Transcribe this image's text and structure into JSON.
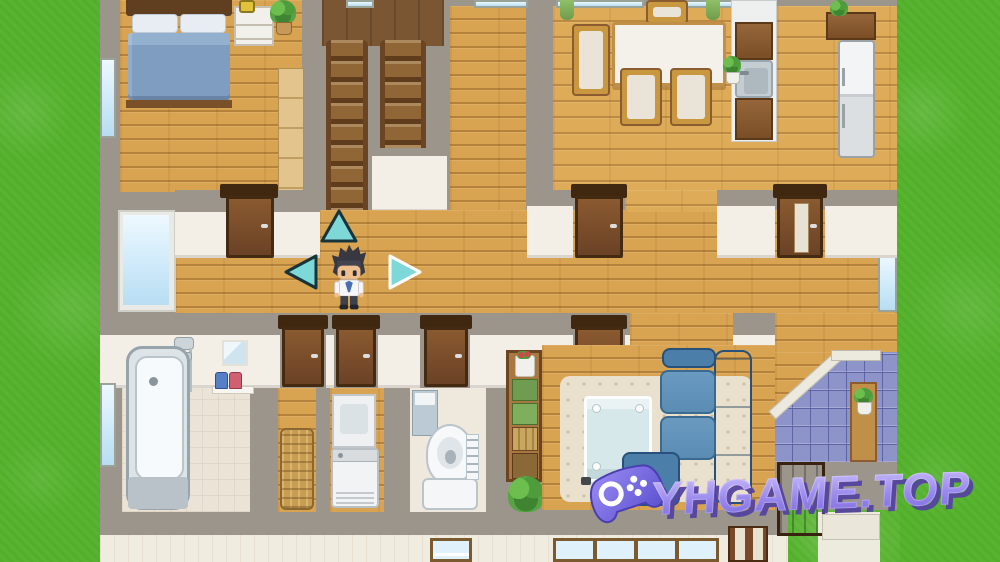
{
  "scene": {
    "description": "Top-down RPG-style house interior map with player character standing in a hallway",
    "rooms": [
      "bedroom",
      "staircase",
      "corridor",
      "dining-room",
      "kitchen",
      "hallway",
      "bathroom",
      "laundry-room",
      "toilet-room",
      "living-room",
      "entryway",
      "yard"
    ],
    "objects": [
      "double-bed",
      "nightstand",
      "alarm-clock",
      "potted-plant",
      "closet",
      "stairs-up",
      "dining-table",
      "chairs",
      "kitchen-sink",
      "refrigerator",
      "bathtub",
      "shower",
      "mirror",
      "shampoo-bottles",
      "laundry-basket",
      "washing-machine",
      "toilet",
      "bookshelf",
      "glass-table",
      "blue-sofa",
      "rug",
      "entry-tiles",
      "front-door"
    ]
  },
  "hud": {
    "arrows": [
      {
        "dir": "up",
        "outline": "dark"
      },
      {
        "dir": "left",
        "outline": "dark"
      },
      {
        "dir": "right",
        "outline": "white"
      }
    ]
  },
  "watermark": {
    "text": "YHGAME.TOP",
    "icon": "gamepad-icon"
  },
  "palette": {
    "grass": "#57b42e",
    "wall": "#9b958b",
    "wall_white": "#f3efe7",
    "wood": "#d9a452",
    "dining_wood": "#deac59",
    "door_dark": "#3f2710",
    "tile_entry": "#8d94c9",
    "bath_floor": "#eae3d6",
    "rug": "#e9e1cd",
    "sofa": "#4b7fa9",
    "sofa_dark": "#3a6a92",
    "glass_table": "#d7e9ec",
    "arrow": "#7fd8d8",
    "exterior_wall": "#f1ece0"
  }
}
